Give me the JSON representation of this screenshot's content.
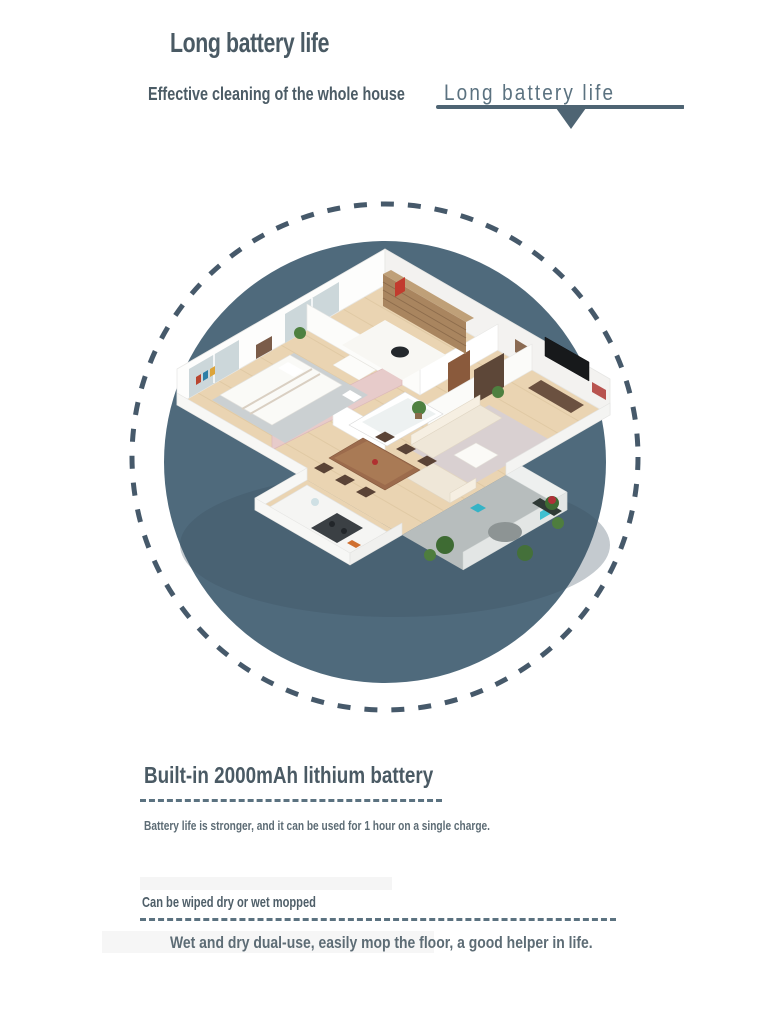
{
  "page": {
    "background": "#ffffff"
  },
  "header": {
    "title": "Long battery life",
    "subtitle": "Effective cleaning of the whole house",
    "subtitle_accent": "Long battery life"
  },
  "hero": {
    "circle_color": "#4f6a7c",
    "ring_color": "#46596a",
    "illustration": "isometric-apartment-floorplan"
  },
  "battery_section": {
    "heading": "Built-in 2000mAh lithium battery",
    "description": "Battery life is stronger, and it can be used for 1 hour on a single charge."
  },
  "mop_section": {
    "heading": "Can be wiped dry or wet mopped",
    "description": "Wet and dry dual-use, easily mop the floor, a good helper in life."
  }
}
